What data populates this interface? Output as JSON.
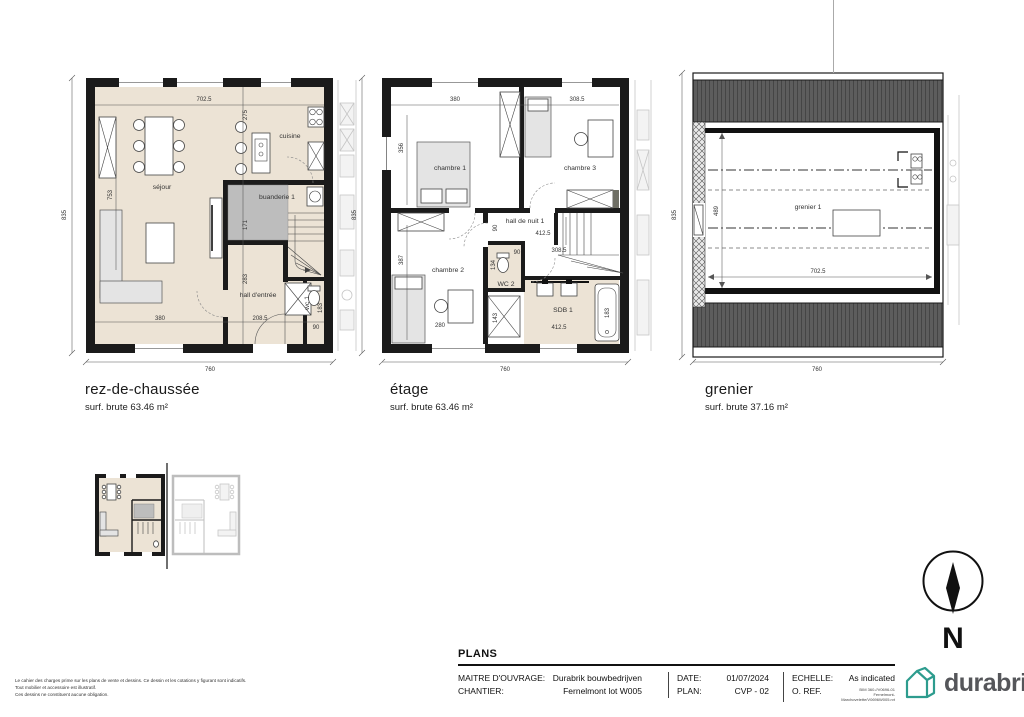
{
  "colors": {
    "wall": "#1b1b1b",
    "floor_beige": "#ece3d5",
    "utility_gray": "#bdbdbd",
    "roof_gray": "#5d5d5d",
    "logo_teal": "#2d9c8e",
    "logo_text_gray": "#55565a",
    "logo_dot_green": "#b5cc34"
  },
  "plans": [
    {
      "title": "rez-de-chaussée",
      "surface": "surf. brute 63.46 m²",
      "rooms": {
        "sejour": "séjour",
        "cuisine": "cuisine",
        "buanderie": "buanderie 1",
        "hall": "hall d'entrée",
        "wc": "wc 1"
      },
      "dims": {
        "h_total": "835",
        "w_total": "760",
        "w_top": "702.5",
        "d275": "275",
        "d753": "753",
        "d171": "171",
        "d283": "283",
        "d380": "380",
        "d2085": "208.5",
        "d90": "90",
        "d183": "183"
      }
    },
    {
      "title": "étage",
      "surface": "surf. brute 63.46 m²",
      "rooms": {
        "chambre1": "chambre 1",
        "chambre2": "chambre 2",
        "chambre3": "chambre 3",
        "hall_nuit": "hall de nuit 1",
        "wc2": "WC 2",
        "sdb": "SDB 1"
      },
      "dims": {
        "h_total": "835",
        "w_total": "760",
        "d380": "380",
        "d3085_top": "308.5",
        "d356": "356",
        "d387": "387",
        "d280": "280",
        "d4125_hall": "412.5",
        "d4125_sdb": "412.5",
        "d90_hall": "90",
        "d90_wc": "90",
        "d134": "134",
        "d143": "143",
        "d183": "183",
        "d3085_mid": "308.5"
      }
    },
    {
      "title": "grenier",
      "surface": "surf. brute 37.16 m²",
      "rooms": {
        "grenier1": "grenier 1"
      },
      "dims": {
        "h_total": "835",
        "w_total": "760",
        "d489": "489",
        "d7025": "702.5"
      }
    }
  ],
  "north": {
    "label": "N"
  },
  "disclaimer": {
    "line1": "Le cahier des charges prime sur les plans de vente et dessins. Ce dessin et les cotations y figurant sont indicatifs.",
    "line2": "Tout mobilier et accessoire est illustratif.",
    "line3": "Ces dessins ne constituent aucune obligation."
  },
  "title_block": {
    "section_title": "PLANS",
    "owner_label": "MAITRE D'OUVRAGE:",
    "owner_value": "Durabrik bouwbedrijven",
    "site_label": "CHANTIER:",
    "site_value": "Fernelmont lot W005",
    "date_label": "DATE:",
    "date_value": "01/07/2024",
    "plan_label": "PLAN:",
    "plan_value": "CVP - 02",
    "scale_label": "ECHELLE:",
    "scale_value": "As indicated",
    "ref_label": "O. REF.",
    "ref_line1": "BIM 360.//V0696-01",
    "ref_line2": "Fernelmont-Marchovelette/V0696W005.rvt"
  },
  "logo": {
    "text": "durabrik"
  }
}
